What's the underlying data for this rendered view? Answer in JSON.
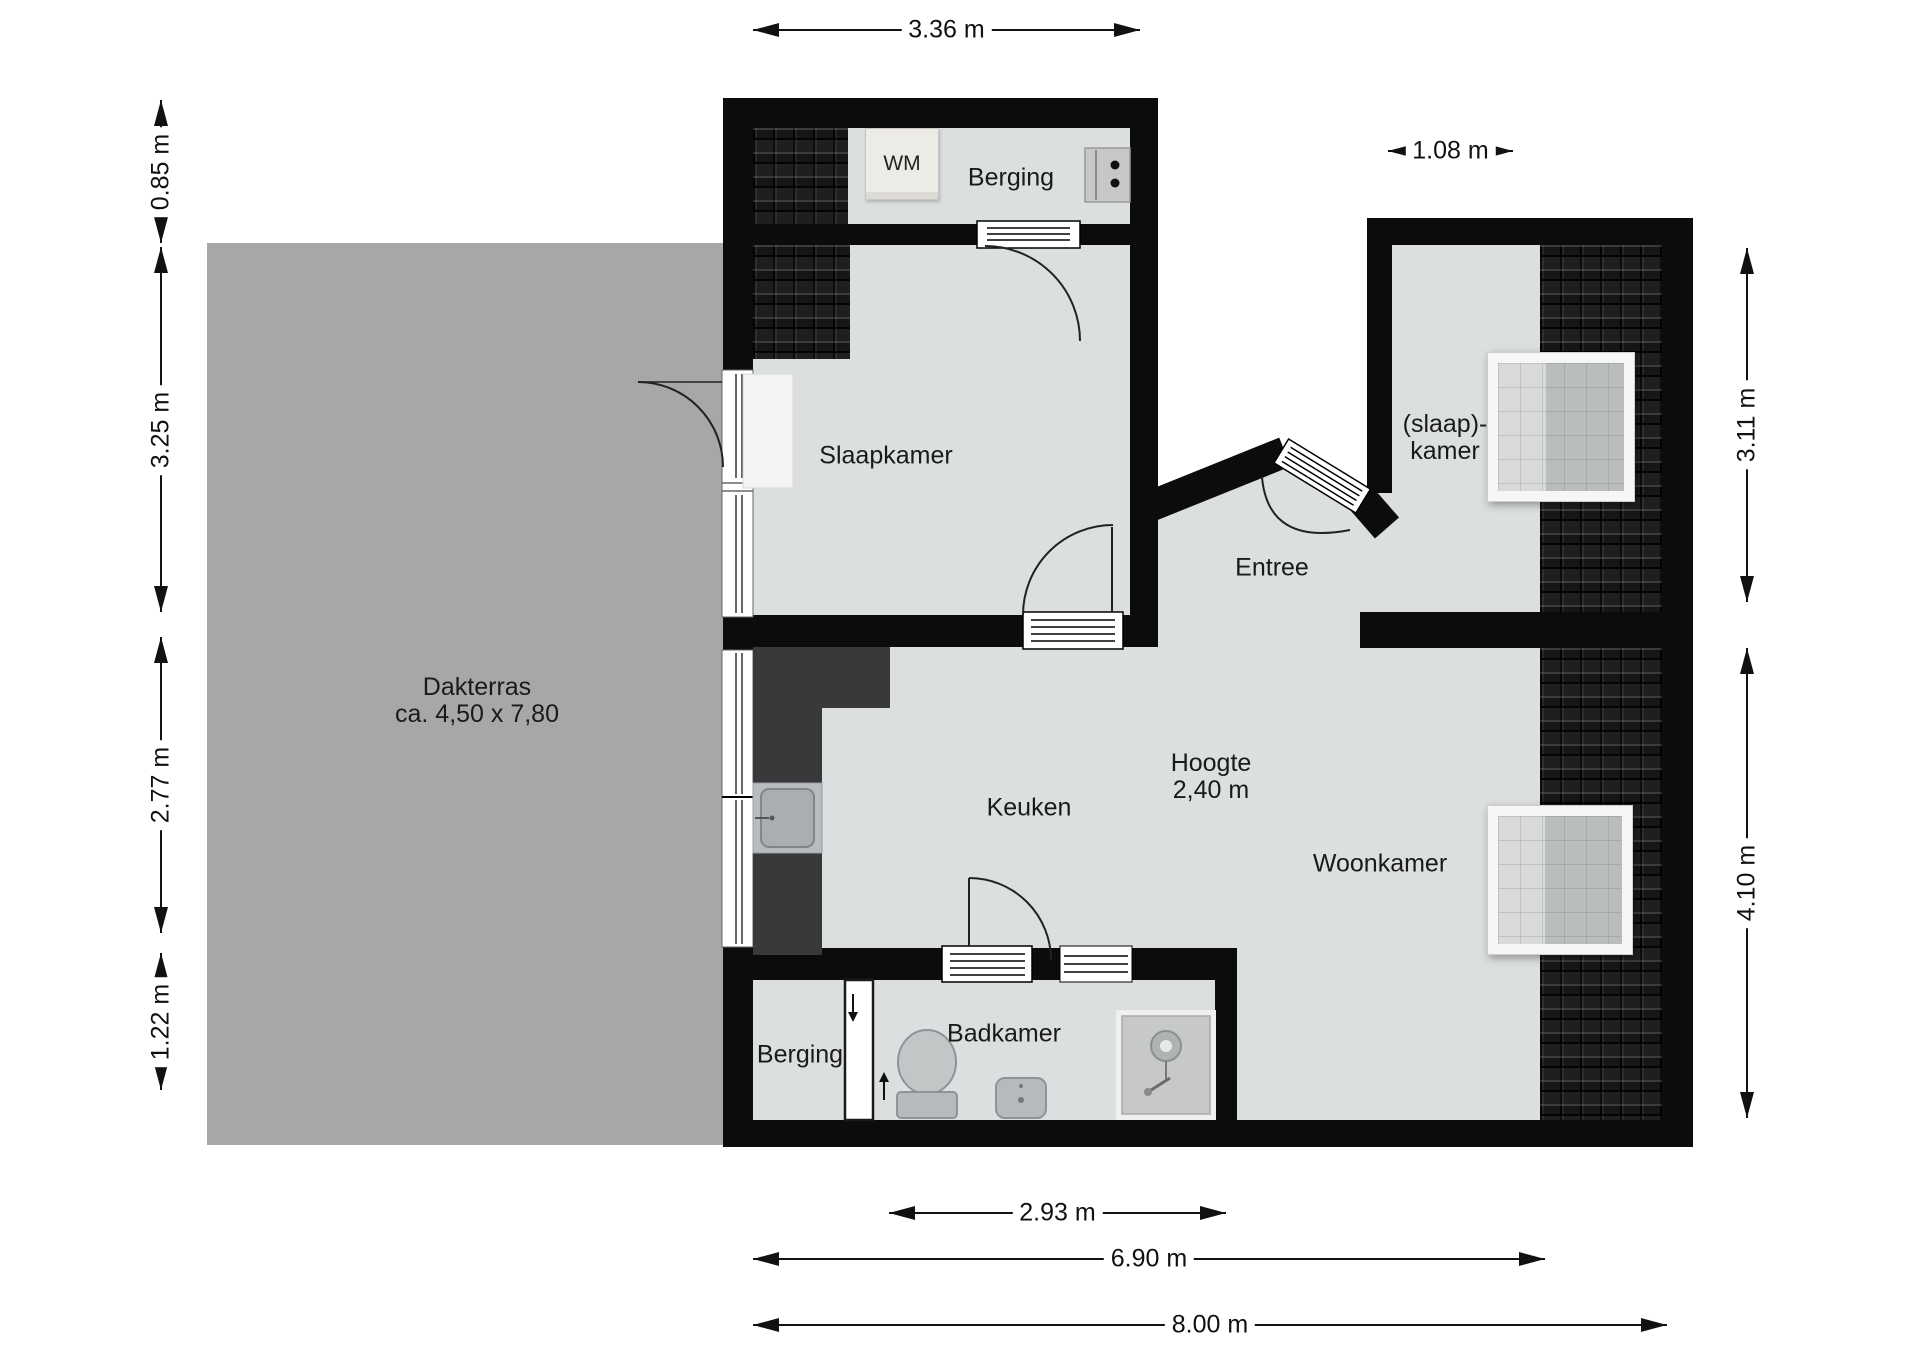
{
  "plan": {
    "type": "floor-plan",
    "units": "m",
    "rooms": {
      "berging_top": "Berging",
      "wm": "WM",
      "slaapkamer": "Slaapkamer",
      "slaapkamer2_line1": "(slaap)-",
      "slaapkamer2_line2": "kamer",
      "entree": "Entree",
      "hoogte_line1": "Hoogte",
      "hoogte_line2": "2,40 m",
      "keuken": "Keuken",
      "woonkamer": "Woonkamer",
      "badkamer": "Badkamer",
      "berging_bottom": "Berging",
      "dakterras_line1": "Dakterras",
      "dakterras_line2": "ca. 4,50 x 7,80"
    },
    "colors": {
      "wall": "#0c0c0c",
      "floor": "#dcdfdf",
      "terrace": "#a7a7a7",
      "counter": "#39393b",
      "tiles": "#161616",
      "text": "#1a1a1a"
    },
    "dimensions": [
      {
        "label": "3.36 m",
        "dir": "h",
        "a": 753,
        "b": 1140,
        "pos": 30
      },
      {
        "label": "1.08 m",
        "dir": "h",
        "a": 1388,
        "b": 1513,
        "pos": 151
      },
      {
        "label": "0.85 m",
        "dir": "v",
        "a": 100,
        "b": 243,
        "pos": 161
      },
      {
        "label": "3.25 m",
        "dir": "v",
        "a": 247,
        "b": 612,
        "pos": 161
      },
      {
        "label": "2.77 m",
        "dir": "v",
        "a": 637,
        "b": 933,
        "pos": 161
      },
      {
        "label": "1.22 m",
        "dir": "v",
        "a": 953,
        "b": 1090,
        "pos": 161
      },
      {
        "label": "3.11 m",
        "dir": "v",
        "a": 248,
        "b": 602,
        "pos": 1747
      },
      {
        "label": "4.10 m",
        "dir": "v",
        "a": 648,
        "b": 1118,
        "pos": 1747
      },
      {
        "label": "2.93 m",
        "dir": "h",
        "a": 889,
        "b": 1226,
        "pos": 1213
      },
      {
        "label": "6.90 m",
        "dir": "h",
        "a": 753,
        "b": 1545,
        "pos": 1259
      },
      {
        "label": "8.00 m",
        "dir": "h",
        "a": 753,
        "b": 1667,
        "pos": 1325
      }
    ]
  }
}
